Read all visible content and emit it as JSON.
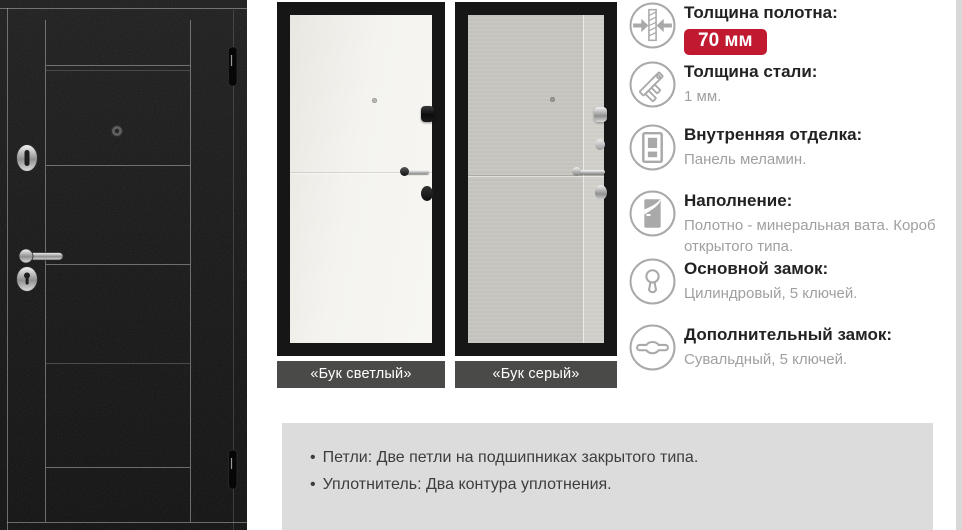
{
  "ui": {
    "bullet": "•"
  },
  "gallery": {
    "variants": [
      {
        "label": "«Бук светлый»"
      },
      {
        "label": "«Бук серый»"
      }
    ]
  },
  "specs": [
    {
      "title": "Толщина полотна:",
      "badge": "70 мм"
    },
    {
      "title": "Толщина стали:",
      "value": "1 мм."
    },
    {
      "title": "Внутренняя отделка:",
      "value": "Панель меламин."
    },
    {
      "title": "Наполнение:",
      "value": "Полотно - минеральная вата. Короб открытого типа."
    },
    {
      "title": "Основной замок:",
      "value": "Цилиндровый, 5 ключей."
    },
    {
      "title": "Дополнительный замок:",
      "value": "Сувальдный, 5 ключей."
    }
  ],
  "features": [
    "Петли: Две петли на подшипниках закрытого типа.",
    "Уплотнитель: Два контура уплотнения."
  ],
  "colors": {
    "badge_bg": "#c11a30",
    "badge_text": "#ffffff",
    "variant_label_bg": "#4a4a49",
    "features_bg": "#dcdcdc",
    "icon_stroke": "#a9a9a9",
    "title_text": "#222222",
    "value_text": "#a0a0a0"
  }
}
